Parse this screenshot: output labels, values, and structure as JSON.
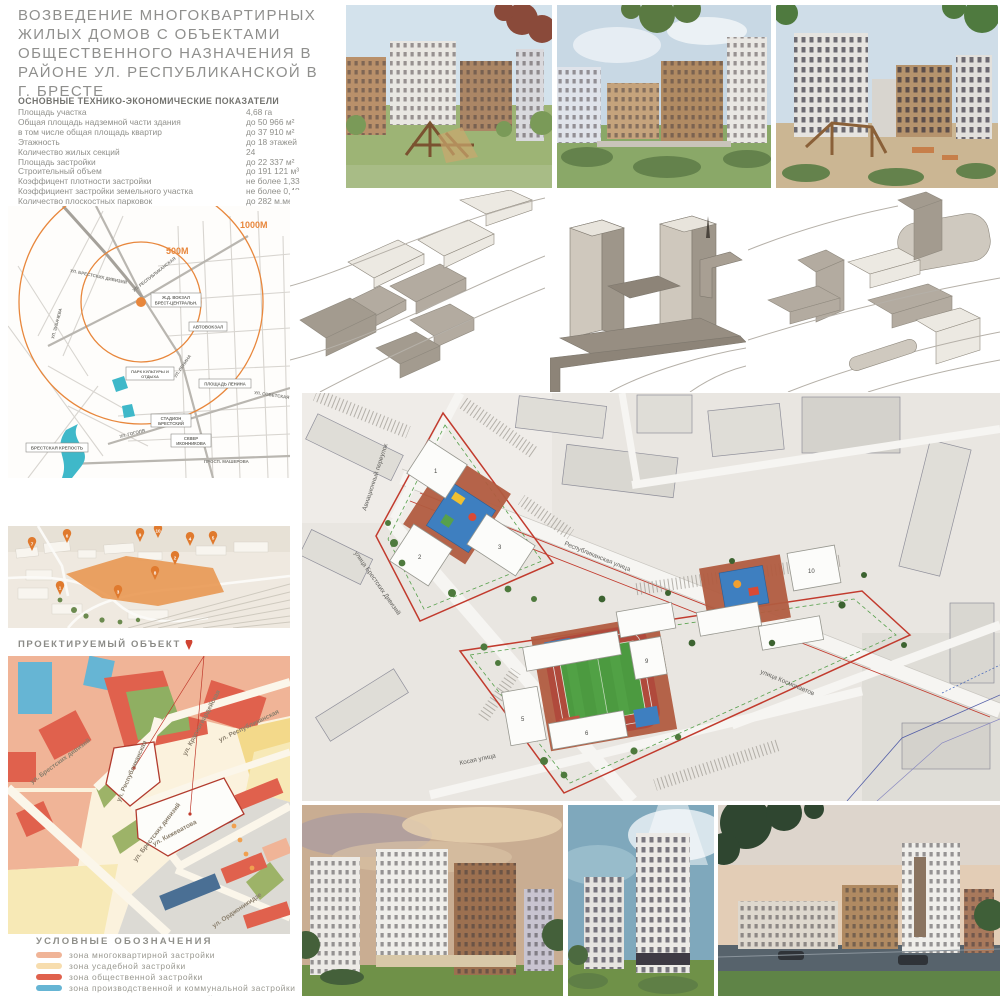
{
  "title_lines": [
    "ВОЗВЕДЕНИЕ МНОГОКВАРТИРНЫХ",
    "ЖИЛЫХ ДОМОВ С ОБЪЕКТАМИ",
    "ОБЩЕСТВЕННОГО НАЗНАЧЕНИЯ В",
    "РАЙОНЕ УЛ. РЕСПУБЛИКАНСКОЙ В",
    "Г. БРЕСТЕ"
  ],
  "indicators": {
    "heading": "ОСНОВНЫЕ ТЕХНИКО-ЭКОНОМИЧЕСКИЕ ПОКАЗАТЕЛИ",
    "rows": [
      {
        "label": "Площадь участка",
        "value": "4,68 га"
      },
      {
        "label": "Общая площадь надземной части здания",
        "value": "до 50 966 м²"
      },
      {
        "label": "в том числе общая площадь квартир",
        "value": "до 37 910 м²"
      },
      {
        "label": "Этажность",
        "value": "до 18 этажей"
      },
      {
        "label": "Количество жилых секций",
        "value": "24"
      },
      {
        "label": "Площадь застройки",
        "value": "до 22 337 м²"
      },
      {
        "label": "Строительный объем",
        "value": "до 191 121 м³"
      },
      {
        "label": "Коэффицент плотности застройки",
        "value": "не более 1,33"
      },
      {
        "label": "Коэффициент застройки земельного участка",
        "value": "не более 0,48"
      },
      {
        "label": "Количество плоскостных парковок",
        "value": "до 282 м.мес"
      },
      {
        "label": "Количество парковок в паркинге",
        "value": "до 301 м.мес"
      }
    ]
  },
  "location_map": {
    "radius_500": "500М",
    "radius_1000": "1000М",
    "pois": {
      "station_l1": "Ж.Д. ВОКЗАЛ",
      "station_l2": "БРЕСТ-ЦЕНТРАЛЬН.",
      "bus": "АВТОВОКЗАЛ",
      "park_l1": "ПАРК КУЛЬТУРЫ И",
      "park_l2": "ОТДЫХА",
      "lenin_square": "ПЛОЩАДЬ ЛЕНИНА",
      "stadium_l1": "СТАДИОН",
      "stadium_l2": "БРЕСТСКИЙ",
      "skver_l1": "СКВЕР",
      "skver_l2": "ИКОННИКОВА",
      "fortress": "БРЕСТСКАЯ КРЕПОСТЬ",
      "masherova": "ПРОСП. МАШЕРОВА"
    },
    "streets": {
      "zubacheva": "УЛ. ЗУБАЧЕВА",
      "divisions": "УЛ. БРЕСТСКИХ ДИВИЗИЙ",
      "respublikanskaya": "УЛ. РЕСПУБЛИКАНСКАЯ",
      "lenina": "УЛ. ЛЕНИНА",
      "gogolya": "УЛ. ГОГОЛЯ",
      "sovetskaya": "УЛ. СОВЕТСКАЯ"
    },
    "accent": "#e8873c"
  },
  "aerial": {
    "caption": "ПРОЕКТИРУЕМЫЙ ОБЪЕКТ",
    "pins": [
      "1",
      "2",
      "3",
      "4",
      "5",
      "6",
      "7",
      "8",
      "9",
      "10"
    ]
  },
  "zoning": {
    "streets": {
      "divisions1": "ул. Брестских дивизий",
      "krasnogvardeyskaya": "ул. Красногвардейская",
      "respublikanskaya_upper": "ул. Республиканская",
      "respublikanskaya_center": "ул. Республиканская",
      "kizhevatova": "ул. Кижеватова",
      "divisions2": "ул. Брестских дивизий",
      "ordzhonikidze": "ул. Орджоникидзе"
    }
  },
  "legend": {
    "heading": "УСЛОВНЫЕ ОБОЗНАЧЕНИЯ",
    "items": [
      {
        "label": "зона многоквартирной застройки",
        "color": "#f0b497"
      },
      {
        "label": "зона усадебной застройки",
        "color": "#f7ddae"
      },
      {
        "label": "зона общественной застройки",
        "color": "#e0614d"
      },
      {
        "label": "зона производственной и коммунальной застройки",
        "color": "#66b5d4"
      },
      {
        "label": "зона транспортных предприятий",
        "color": "#53778f"
      }
    ]
  },
  "masterplan": {
    "streets": {
      "aviatsionny": "Авиационный переулок",
      "divisions": "улица Брестских Дивизий",
      "respublikanskaya": "Республиканская улица",
      "kosaya": "Косая улица",
      "kosmonavtov": "улица Космонавтов"
    },
    "building_numbers": [
      "1",
      "2",
      "3",
      "5",
      "6",
      "9",
      "10"
    ],
    "palette": {
      "site_boundary_red": "#c23b2e",
      "playground_blue": "#3e7fc0",
      "courtyard_terracotta": "#b25c41",
      "field_green": "#4c9a40",
      "accent_orange": "#e8873c"
    }
  }
}
